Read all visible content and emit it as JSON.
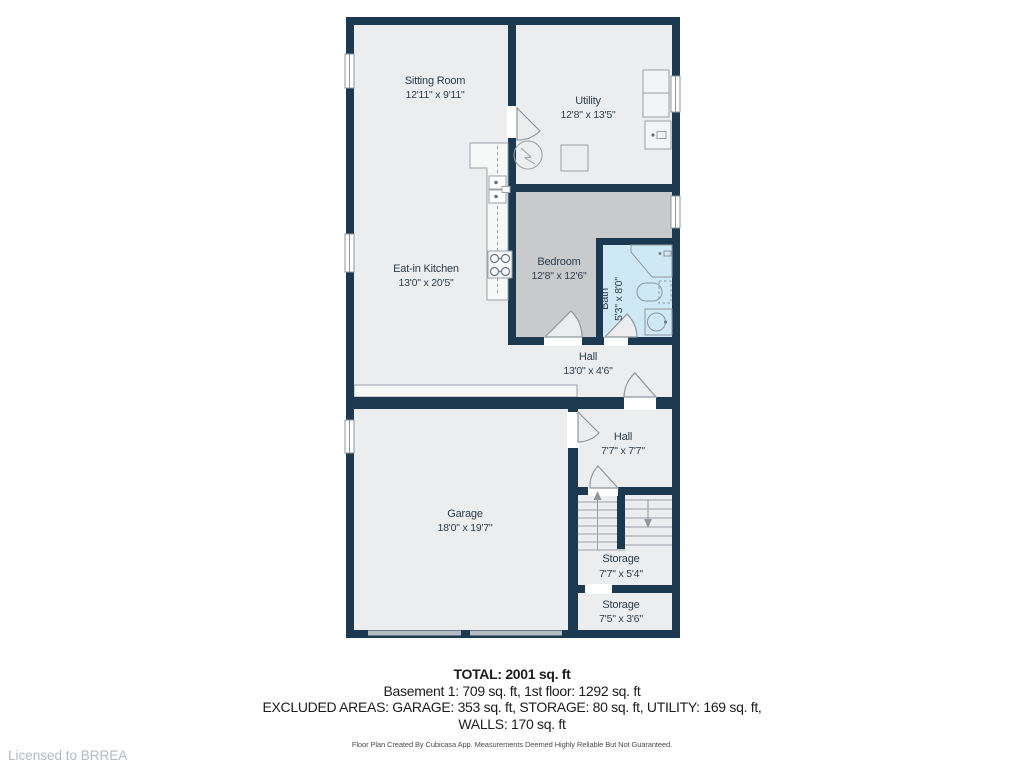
{
  "floor_plan": {
    "rooms": {
      "sitting_room": {
        "name": "Sitting Room",
        "dims": "12'11\" x 9'11\""
      },
      "utility": {
        "name": "Utility",
        "dims": "12'8\" x 13'5\""
      },
      "eat_in_kitchen": {
        "name": "Eat-in Kitchen",
        "dims": "13'0\" x 20'5\""
      },
      "bedroom": {
        "name": "Bedroom",
        "dims": "12'8\" x 12'6\""
      },
      "bath": {
        "name": "Bath",
        "dims": "5'3\" x 8'0\""
      },
      "hall_upper": {
        "name": "Hall",
        "dims": "13'0\" x 4'6\""
      },
      "hall_lower": {
        "name": "Hall",
        "dims": "7'7\" x 7'7\""
      },
      "garage": {
        "name": "Garage",
        "dims": "18'0\" x 19'7\""
      },
      "storage_under_stairs": {
        "name": "Storage",
        "dims": "7'7\" x 5'4\""
      },
      "storage_bottom": {
        "name": "Storage",
        "dims": "7'5\" x 3'6\""
      }
    },
    "colors": {
      "wall": "#1b3a52",
      "floor": "#ecedee",
      "bedroom_floor": "#c9cacc",
      "bath_floor": "#cfe8f5",
      "fixture_outline": "#979ea5",
      "label_text": "#2b3e50",
      "garage_door": "#b5bbc1",
      "license_text": "#b3bac1"
    },
    "summary": {
      "total": "TOTAL: 2001 sq. ft",
      "floors_line": "Basement 1: 709 sq. ft, 1st floor: 1292 sq. ft",
      "excluded_line": "EXCLUDED AREAS: GARAGE: 353 sq. ft, STORAGE: 80 sq. ft, UTILITY: 169 sq. ft,",
      "walls_line": "WALLS: 170 sq. ft",
      "disclaimer": "Floor Plan Created By Cubicasa App. Measurements Deemed Highly Reliable But Not Guaranteed."
    },
    "license": "Licensed to BRREA"
  }
}
